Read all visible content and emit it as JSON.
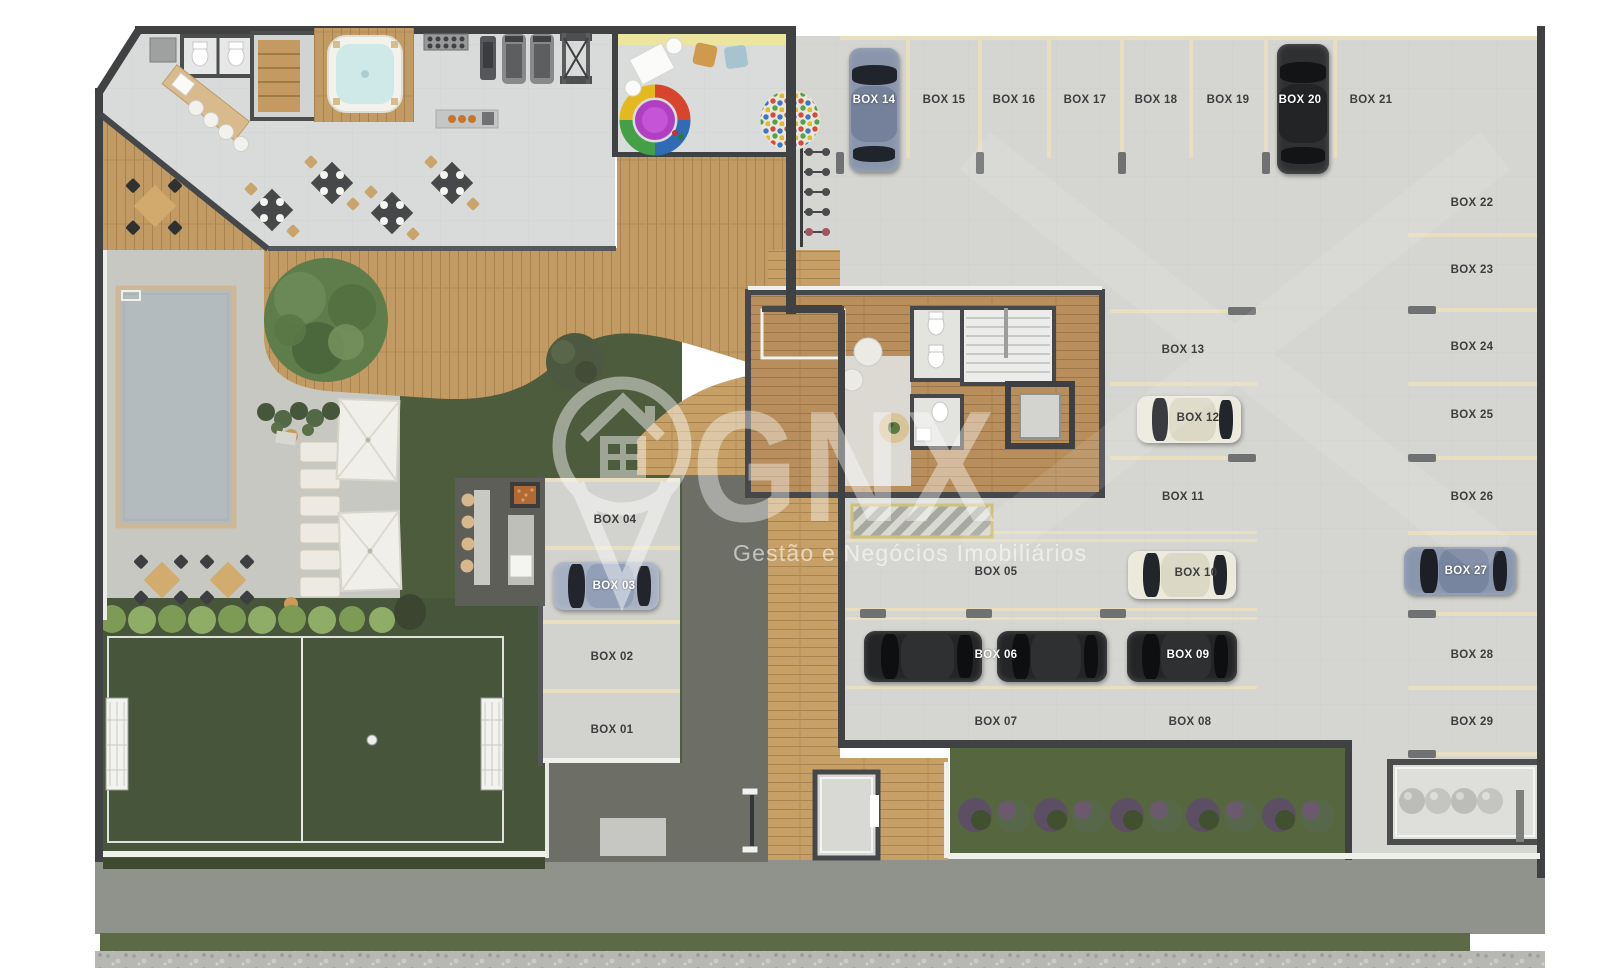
{
  "watermark": {
    "brand": "GNX",
    "tagline": "Gestão e Negócios Imobiliários"
  },
  "parking": {
    "label_color_dark": "#3c3e3f",
    "label_color_light": "#ffffff",
    "stripe_color": "#e7dfc0",
    "boxes": [
      {
        "label": "BOX 01",
        "x": 612,
        "y": 730,
        "light": false
      },
      {
        "label": "BOX 02",
        "x": 612,
        "y": 657,
        "light": false
      },
      {
        "label": "BOX 03",
        "x": 614,
        "y": 586,
        "light": true
      },
      {
        "label": "BOX 04",
        "x": 615,
        "y": 520,
        "light": false
      },
      {
        "label": "BOX 05",
        "x": 996,
        "y": 572,
        "light": false
      },
      {
        "label": "BOX 06",
        "x": 996,
        "y": 655,
        "light": true
      },
      {
        "label": "BOX 07",
        "x": 996,
        "y": 722,
        "light": false
      },
      {
        "label": "BOX 08",
        "x": 1190,
        "y": 722,
        "light": false
      },
      {
        "label": "BOX 09",
        "x": 1188,
        "y": 655,
        "light": true
      },
      {
        "label": "BOX 10",
        "x": 1196,
        "y": 573,
        "light": false
      },
      {
        "label": "BOX 11",
        "x": 1183,
        "y": 497,
        "light": false
      },
      {
        "label": "BOX 12",
        "x": 1198,
        "y": 418,
        "light": false
      },
      {
        "label": "BOX 13",
        "x": 1183,
        "y": 350,
        "light": false
      },
      {
        "label": "BOX 14",
        "x": 874,
        "y": 100,
        "light": true
      },
      {
        "label": "BOX 15",
        "x": 944,
        "y": 100,
        "light": false
      },
      {
        "label": "BOX 16",
        "x": 1014,
        "y": 100,
        "light": false
      },
      {
        "label": "BOX 17",
        "x": 1085,
        "y": 100,
        "light": false
      },
      {
        "label": "BOX 18",
        "x": 1156,
        "y": 100,
        "light": false
      },
      {
        "label": "BOX 19",
        "x": 1228,
        "y": 100,
        "light": false
      },
      {
        "label": "BOX 20",
        "x": 1300,
        "y": 100,
        "light": true
      },
      {
        "label": "BOX 21",
        "x": 1371,
        "y": 100,
        "light": false
      },
      {
        "label": "BOX 22",
        "x": 1472,
        "y": 203,
        "light": false
      },
      {
        "label": "BOX 23",
        "x": 1472,
        "y": 270,
        "light": false
      },
      {
        "label": "BOX 24",
        "x": 1472,
        "y": 347,
        "light": false
      },
      {
        "label": "BOX 25",
        "x": 1472,
        "y": 415,
        "light": false
      },
      {
        "label": "BOX 26",
        "x": 1472,
        "y": 497,
        "light": false
      },
      {
        "label": "BOX 27",
        "x": 1466,
        "y": 571,
        "light": true
      },
      {
        "label": "BOX 28",
        "x": 1472,
        "y": 655,
        "light": false
      },
      {
        "label": "BOX 29",
        "x": 1472,
        "y": 722,
        "light": false
      }
    ],
    "cars": [
      {
        "box": "BOX 14",
        "x": 849,
        "y": 48,
        "w": 50,
        "h": 124,
        "dir": "v",
        "body": "#8a95ab",
        "glass": "#20242c",
        "roof": "#75819a"
      },
      {
        "box": "BOX 20",
        "x": 1277,
        "y": 44,
        "w": 52,
        "h": 130,
        "dir": "v",
        "body": "#2e3032",
        "glass": "#131416",
        "roof": "#222426"
      },
      {
        "box": "BOX 12",
        "x": 1137,
        "y": 396,
        "w": 104,
        "h": 47,
        "dir": "h",
        "body": "#ece9dd",
        "glass": "#22252a",
        "roof": "#dcd8c6"
      },
      {
        "box": "BOX 10",
        "x": 1128,
        "y": 551,
        "w": 108,
        "h": 48,
        "dir": "h",
        "body": "#ece9dd",
        "glass": "#22252a",
        "roof": "#dcd8c6"
      },
      {
        "box": "BOX 27",
        "x": 1404,
        "y": 547,
        "w": 112,
        "h": 48,
        "dir": "h",
        "body": "#8a96ad",
        "glass": "#1c1f26",
        "roof": "#78859f"
      },
      {
        "box": "BOX 03",
        "x": 553,
        "y": 562,
        "w": 106,
        "h": 48,
        "dir": "h",
        "body": "#a7b0c2",
        "glass": "#22252c",
        "roof": "#929fb7"
      },
      {
        "box": "BOX 06",
        "x": 864,
        "y": 631,
        "w": 118,
        "h": 51,
        "dir": "h",
        "body": "#232527",
        "glass": "#0e0f11",
        "roof": "#2e3032"
      },
      {
        "box": "",
        "x": 997,
        "y": 631,
        "w": 110,
        "h": 51,
        "dir": "h",
        "body": "#232527",
        "glass": "#0e0f11",
        "roof": "#2e3032"
      },
      {
        "box": "BOX 09",
        "x": 1127,
        "y": 631,
        "w": 110,
        "h": 51,
        "dir": "h",
        "body": "#232527",
        "glass": "#0e0f11",
        "roof": "#2e3032"
      }
    ]
  }
}
